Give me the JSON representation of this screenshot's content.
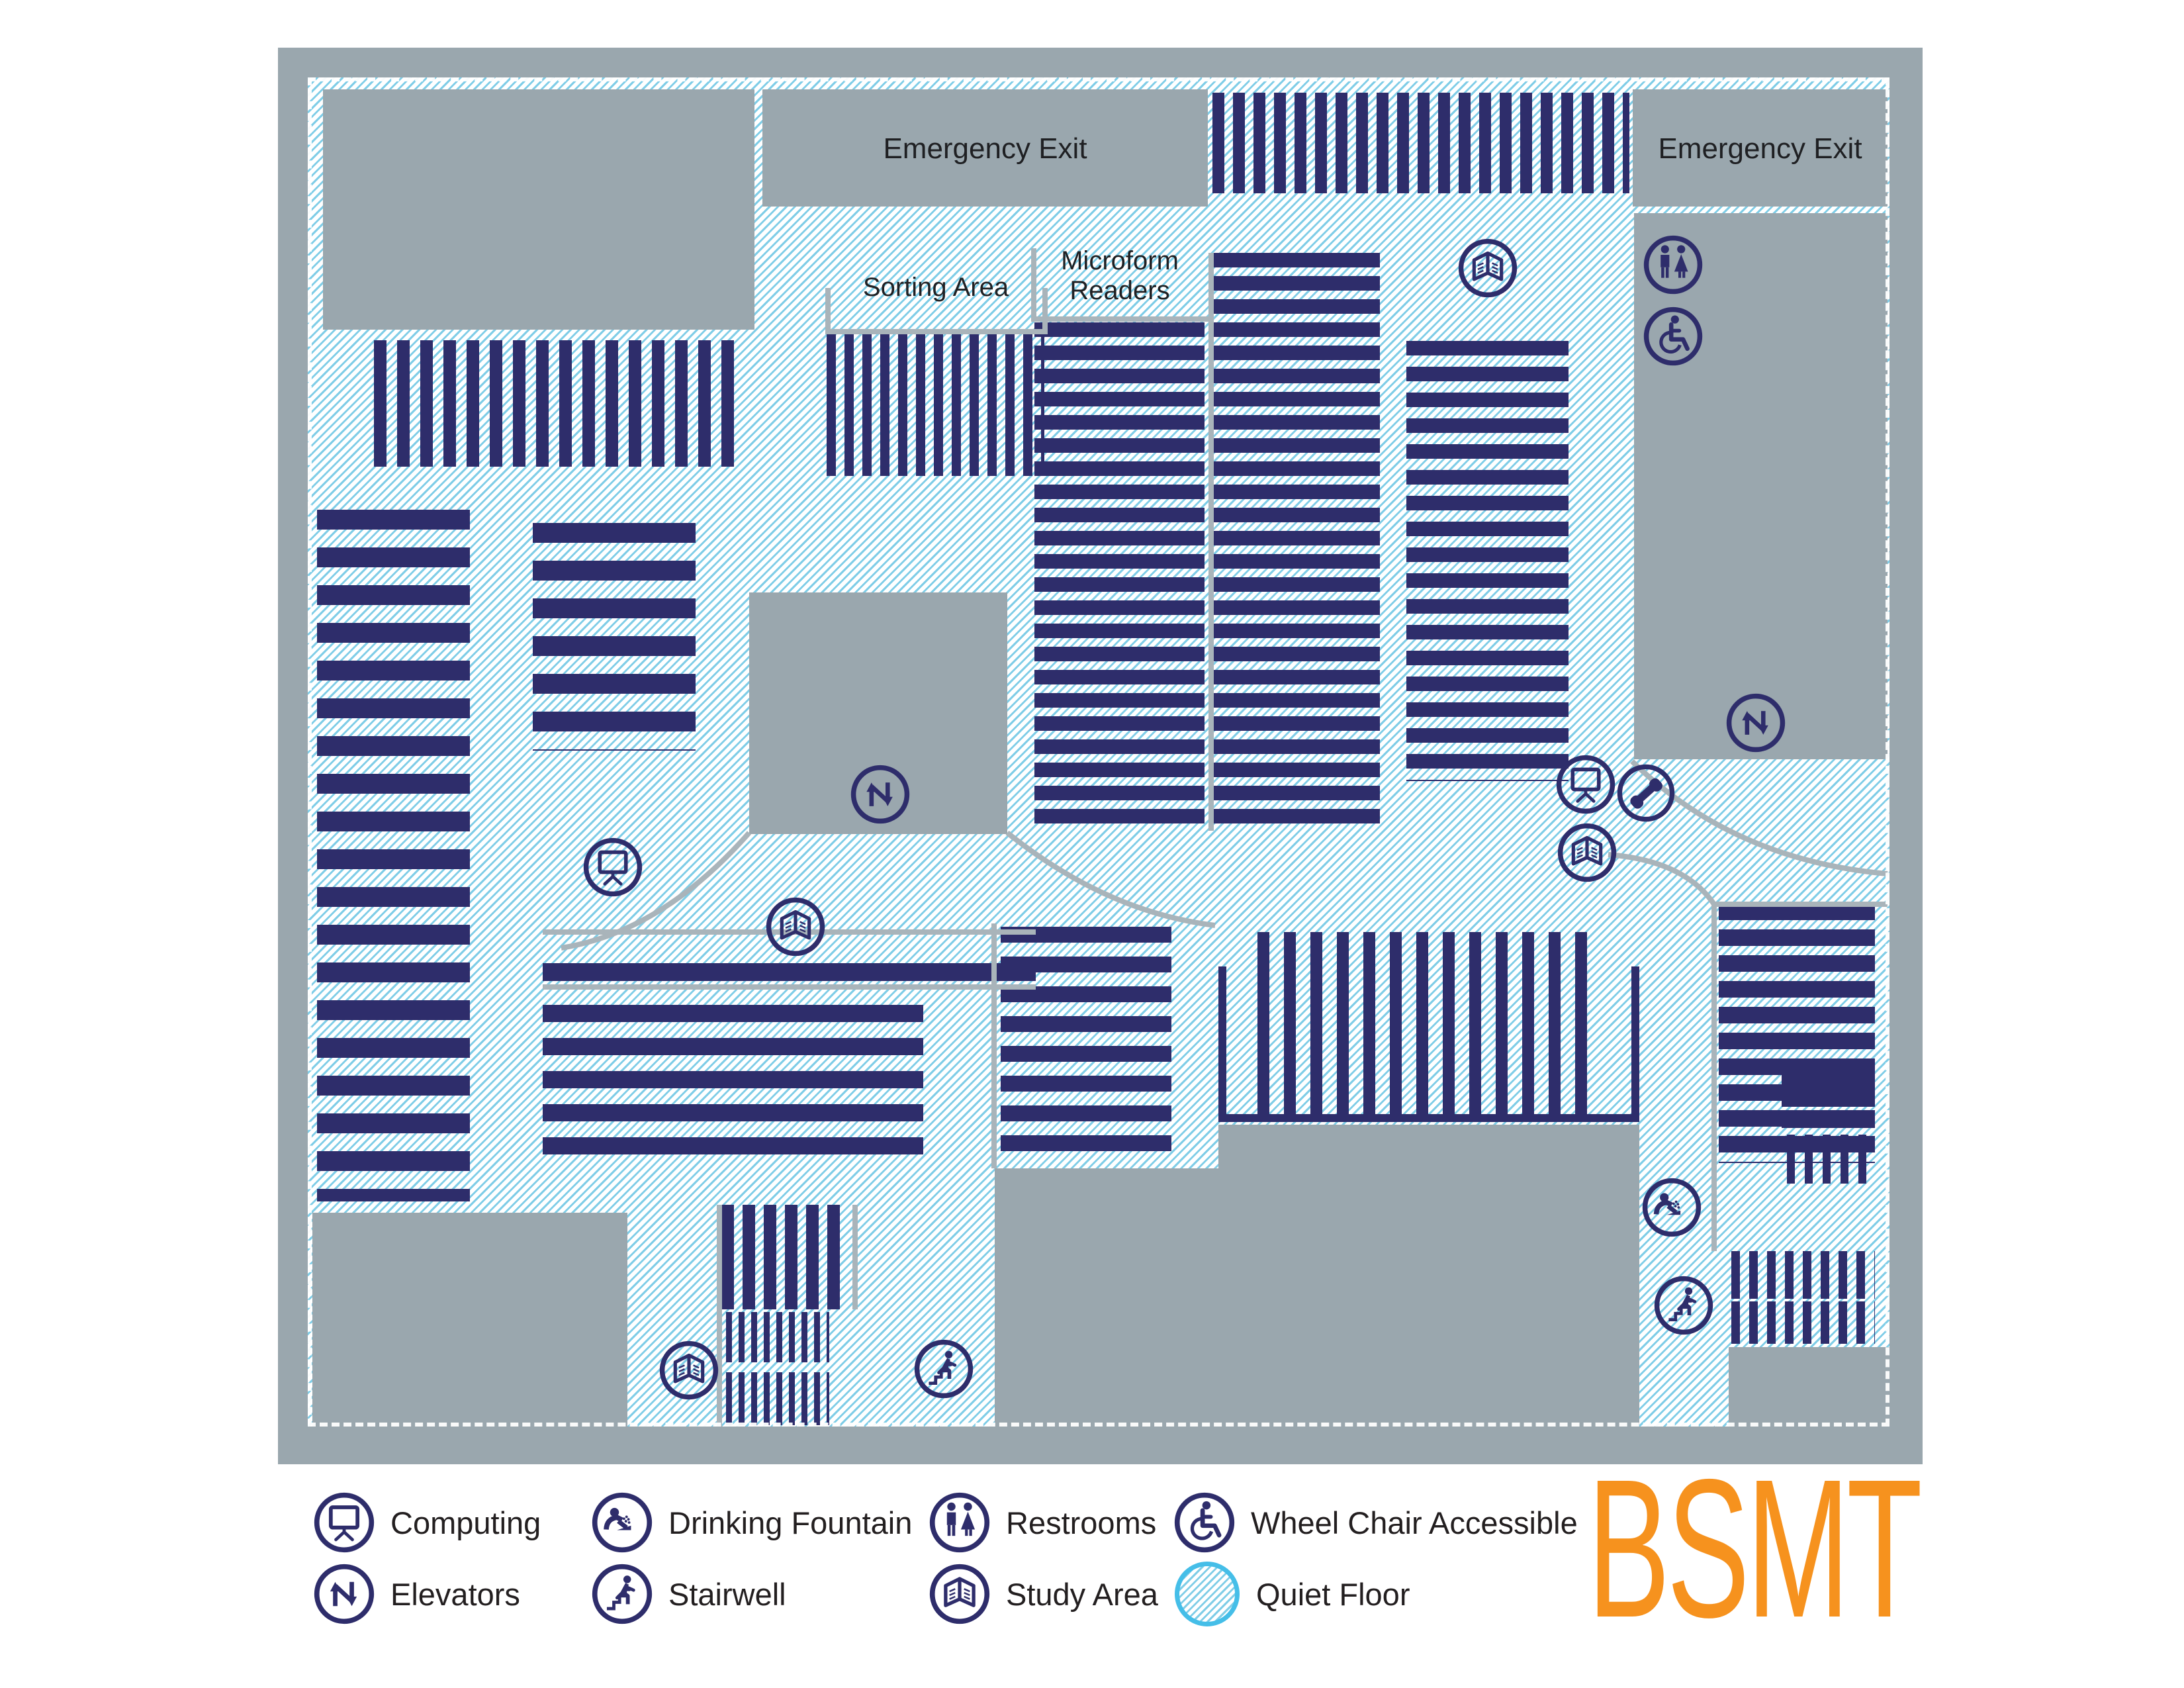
{
  "floor_code": "BSMT",
  "labels": {
    "emergency_exit_top_center": "Emergency Exit",
    "emergency_exit_top_right": "Emergency Exit",
    "sorting_area": "Sorting Area",
    "microform_line1": "Microform",
    "microform_line2": "Readers"
  },
  "legend": {
    "items": [
      {
        "icon": "computing-icon",
        "label": "Computing"
      },
      {
        "icon": "drinking-fountain-icon",
        "label": "Drinking Fountain"
      },
      {
        "icon": "restrooms-icon",
        "label": "Restrooms"
      },
      {
        "icon": "wheel-chair-accessible-icon",
        "label": "Wheel Chair Accessible"
      },
      {
        "icon": "elevators-icon",
        "label": "Elevators"
      },
      {
        "icon": "stairwell-icon",
        "label": "Stairwell"
      },
      {
        "icon": "study-area-icon",
        "label": "Study Area"
      },
      {
        "icon": "quiet-floor-swatch",
        "label": "Quiet Floor"
      }
    ]
  },
  "map_icons": [
    "restrooms-icon",
    "wheel-chair-accessible-icon",
    "elevators-icon",
    "elevators-icon",
    "study-area-icon",
    "study-area-icon",
    "study-area-icon",
    "study-area-icon",
    "computing-icon",
    "computing-icon",
    "telephone-icon",
    "stairwell-icon",
    "stairwell-icon",
    "drinking-fountain-icon"
  ],
  "colors": {
    "stack_navy": "#2e2d6b",
    "room_gray": "#9aa7ae",
    "hatch_line_blue": "#7fcde7",
    "hatch_background": "#ffffff",
    "wall_gray": "#a9b4ba",
    "accent_orange": "#f6921e",
    "label_text": "#1f2023",
    "quiet_floor_ring_blue": "#45bee8"
  }
}
